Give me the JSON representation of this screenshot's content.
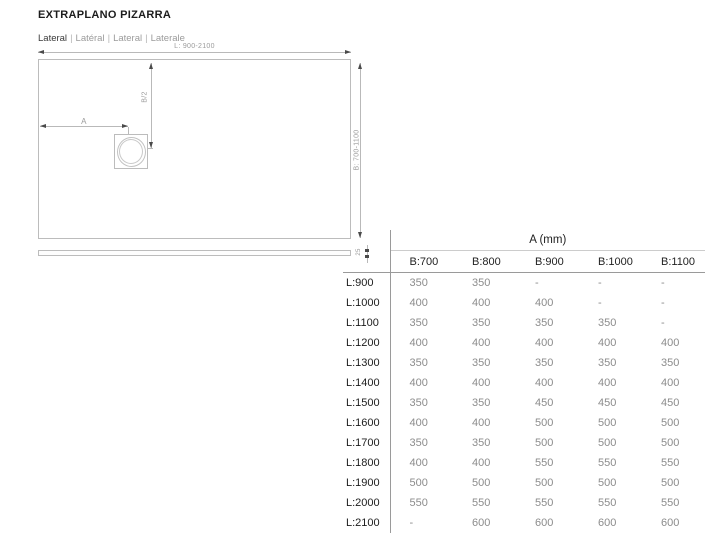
{
  "page": {
    "title": "EXTRAPLANO PIZARRA",
    "subtitle": {
      "parts": [
        "Lateral",
        "Latéral",
        "Lateral",
        "Laterale"
      ],
      "separator": "|"
    }
  },
  "diagram": {
    "length_label": "L: 900-2100",
    "width_label": "B: 700-1100",
    "half_width_label": "B/2",
    "offset_label": "A",
    "thickness_label": "25"
  },
  "table": {
    "title": "A (mm)",
    "col_headers": [
      "B:700",
      "B:800",
      "B:900",
      "B:1000",
      "B:1100"
    ],
    "rows": [
      {
        "label": "L:900",
        "values": [
          "350",
          "350",
          "-",
          "-",
          "-"
        ]
      },
      {
        "label": "L:1000",
        "values": [
          "400",
          "400",
          "400",
          "-",
          "-"
        ]
      },
      {
        "label": "L:1100",
        "values": [
          "350",
          "350",
          "350",
          "350",
          "-"
        ]
      },
      {
        "label": "L:1200",
        "values": [
          "400",
          "400",
          "400",
          "400",
          "400"
        ]
      },
      {
        "label": "L:1300",
        "values": [
          "350",
          "350",
          "350",
          "350",
          "350"
        ]
      },
      {
        "label": "L:1400",
        "values": [
          "400",
          "400",
          "400",
          "400",
          "400"
        ]
      },
      {
        "label": "L:1500",
        "values": [
          "350",
          "350",
          "450",
          "450",
          "450"
        ]
      },
      {
        "label": "L:1600",
        "values": [
          "400",
          "400",
          "500",
          "500",
          "500"
        ]
      },
      {
        "label": "L:1700",
        "values": [
          "350",
          "350",
          "500",
          "500",
          "500"
        ]
      },
      {
        "label": "L:1800",
        "values": [
          "400",
          "400",
          "550",
          "550",
          "550"
        ]
      },
      {
        "label": "L:1900",
        "values": [
          "500",
          "500",
          "500",
          "500",
          "500"
        ]
      },
      {
        "label": "L:2000",
        "values": [
          "550",
          "550",
          "550",
          "550",
          "550"
        ]
      },
      {
        "label": "L:2100",
        "values": [
          "-",
          "600",
          "600",
          "600",
          "600"
        ]
      }
    ]
  },
  "colors": {
    "background": "#ffffff",
    "title_text": "#1c1c1c",
    "muted_text": "#9b9b9b",
    "table_value_text": "#8c8c8c",
    "drawing_line": "#bcbcbc",
    "table_rule": "#9a9a9a"
  }
}
